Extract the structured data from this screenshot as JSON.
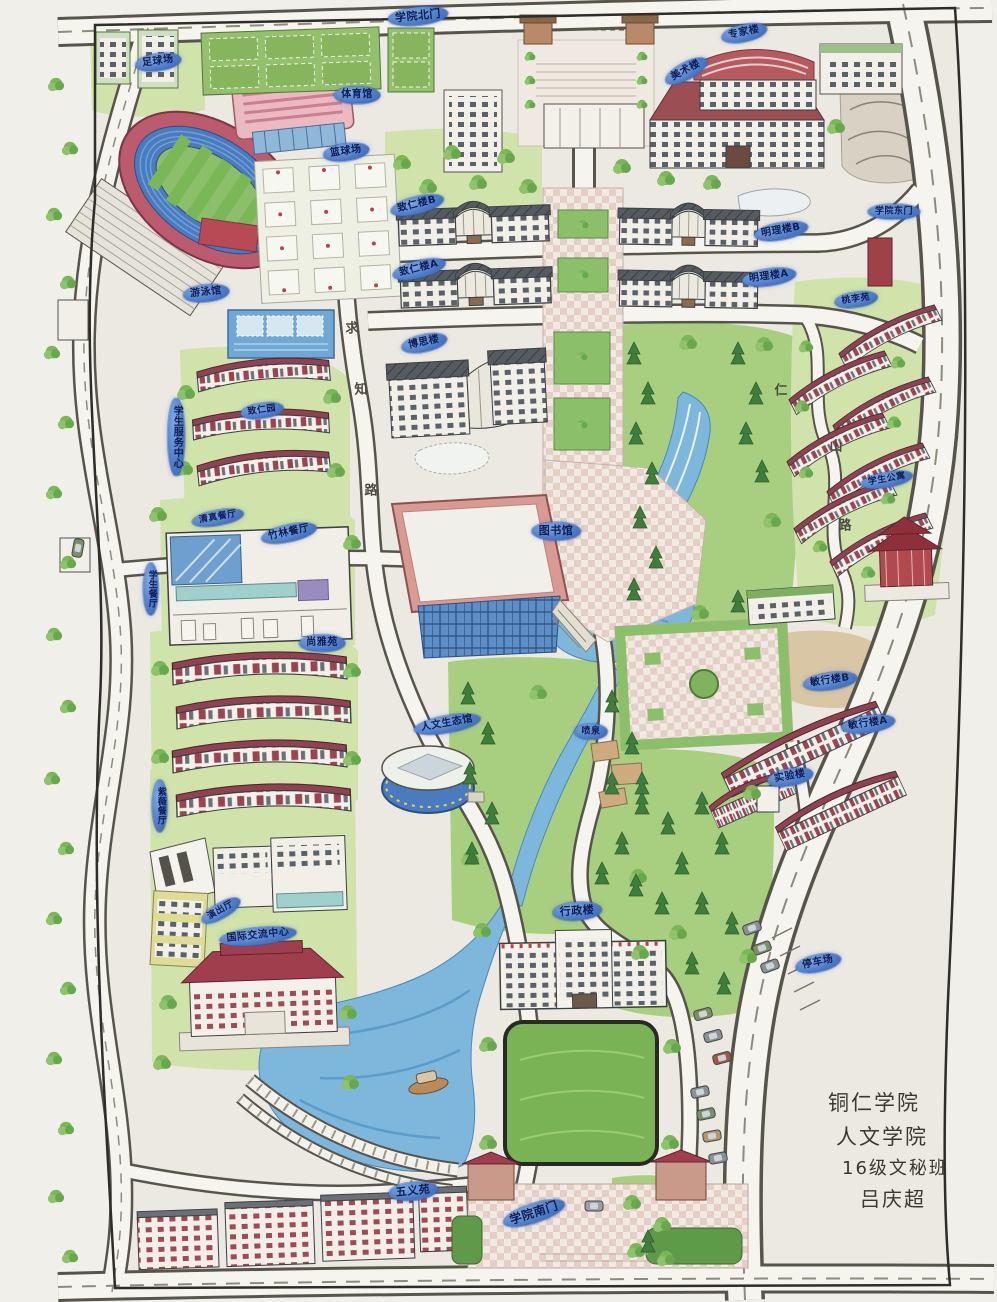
{
  "signature": {
    "lines": [
      "铜仁学院",
      "人文学院",
      "16级文秘班",
      "吕庆超"
    ]
  },
  "labels": [
    {
      "id": "north-gate",
      "text": "学院北门",
      "x": 418,
      "y": 16,
      "rot": -6,
      "fs": 11
    },
    {
      "id": "art-building",
      "text": "美术楼",
      "x": 686,
      "y": 71,
      "rot": -28
    },
    {
      "id": "expert-building",
      "text": "专家楼",
      "x": 744,
      "y": 33,
      "rot": -12
    },
    {
      "id": "football-field",
      "text": "足球场",
      "x": 158,
      "y": 62,
      "rot": -8
    },
    {
      "id": "gymnasium",
      "text": "体育馆",
      "x": 357,
      "y": 95,
      "rot": 0
    },
    {
      "id": "basketball-court",
      "text": "篮球场",
      "x": 346,
      "y": 152,
      "rot": -8
    },
    {
      "id": "swimming-pool",
      "text": "游泳馆",
      "x": 206,
      "y": 293,
      "rot": -6
    },
    {
      "id": "zhiren-building-b",
      "text": "致仁楼B",
      "x": 417,
      "y": 205,
      "rot": -14
    },
    {
      "id": "mingli-building-b",
      "text": "明理楼B",
      "x": 781,
      "y": 231,
      "rot": -10
    },
    {
      "id": "zhiren-building-a",
      "text": "致仁楼A",
      "x": 419,
      "y": 269,
      "rot": -14
    },
    {
      "id": "mingli-building-a",
      "text": "明理楼A",
      "x": 769,
      "y": 277,
      "rot": -8
    },
    {
      "id": "bosi-building",
      "text": "博思楼",
      "x": 424,
      "y": 343,
      "rot": -12
    },
    {
      "id": "student-service-center",
      "text": "学生服务中心",
      "x": 176,
      "y": 437,
      "vertical": true
    },
    {
      "id": "zhiren-garden",
      "text": "致仁园",
      "x": 262,
      "y": 411,
      "rot": -8,
      "fs": 9
    },
    {
      "id": "qingzhen-canteen",
      "text": "清真餐厅",
      "x": 218,
      "y": 518,
      "rot": -10,
      "fs": 9
    },
    {
      "id": "zhulin-canteen",
      "text": "竹林餐厅",
      "x": 289,
      "y": 533,
      "rot": -12
    },
    {
      "id": "student-canteen",
      "text": "学生餐厅",
      "x": 151,
      "y": 589,
      "vertical": true,
      "fs": 9
    },
    {
      "id": "shangya-garden",
      "text": "尚雅苑",
      "x": 322,
      "y": 643,
      "rot": 0
    },
    {
      "id": "library",
      "text": "图书馆",
      "x": 556,
      "y": 531,
      "rot": 0,
      "fs": 11
    },
    {
      "id": "humanities-eco-hall",
      "text": "人文生态馆",
      "x": 447,
      "y": 724,
      "rot": -10
    },
    {
      "id": "fountain",
      "text": "喷泉",
      "x": 591,
      "y": 732,
      "rot": 0,
      "fs": 9
    },
    {
      "id": "minxing-building-b",
      "text": "敏行楼B",
      "x": 830,
      "y": 681,
      "rot": -8
    },
    {
      "id": "minxing-building-a",
      "text": "敏行楼A",
      "x": 868,
      "y": 724,
      "rot": -8
    },
    {
      "id": "laboratory-building",
      "text": "实验楼",
      "x": 790,
      "y": 777,
      "rot": -10
    },
    {
      "id": "admin-building",
      "text": "行政楼",
      "x": 577,
      "y": 911,
      "rot": -4,
      "fs": 11
    },
    {
      "id": "parking-lot",
      "text": "停车场",
      "x": 818,
      "y": 963,
      "rot": -12
    },
    {
      "id": "performance-hall",
      "text": "演出厅",
      "x": 221,
      "y": 911,
      "rot": -30,
      "fs": 9
    },
    {
      "id": "intl-exchange-center",
      "text": "国际交流中心",
      "x": 258,
      "y": 936,
      "rot": -6
    },
    {
      "id": "wuyi-garden",
      "text": "五义苑",
      "x": 413,
      "y": 1191,
      "rot": -6,
      "fs": 11
    },
    {
      "id": "south-gate",
      "text": "学院南门",
      "x": 534,
      "y": 1213,
      "rot": -18,
      "fs": 12
    },
    {
      "id": "east-gate",
      "text": "学院东门",
      "x": 894,
      "y": 212,
      "rot": 0,
      "fs": 9
    },
    {
      "id": "taoli-garden",
      "text": "桃李苑",
      "x": 856,
      "y": 300,
      "rot": -8,
      "fs": 9
    },
    {
      "id": "student-apartment",
      "text": "学生公寓",
      "x": 887,
      "y": 480,
      "rot": -10,
      "fs": 9
    },
    {
      "id": "ziwei-canteen",
      "text": "紫薇餐厅",
      "x": 160,
      "y": 806,
      "vertical": true,
      "fs": 9
    }
  ],
  "road_glyphs": [
    {
      "text": "求",
      "x": 352,
      "y": 327
    },
    {
      "text": "知",
      "x": 361,
      "y": 388
    },
    {
      "text": "路",
      "x": 371,
      "y": 489
    },
    {
      "text": "仁",
      "x": 781,
      "y": 389
    },
    {
      "text": "山",
      "x": 836,
      "y": 445
    },
    {
      "text": "路",
      "x": 845,
      "y": 524
    }
  ],
  "colors": {
    "label_bg": "#4a79c6",
    "label_text": "#0e1c55",
    "water": "#7db7dc",
    "grass_light": "#cfe3ab",
    "grass": "#8fc36b",
    "track_red": "#bc5a6e",
    "track_blue": "#4a7bbf",
    "roof_maroon": "#9c4352",
    "paper": "#ebe9e2",
    "road": "#f6f4ee"
  }
}
